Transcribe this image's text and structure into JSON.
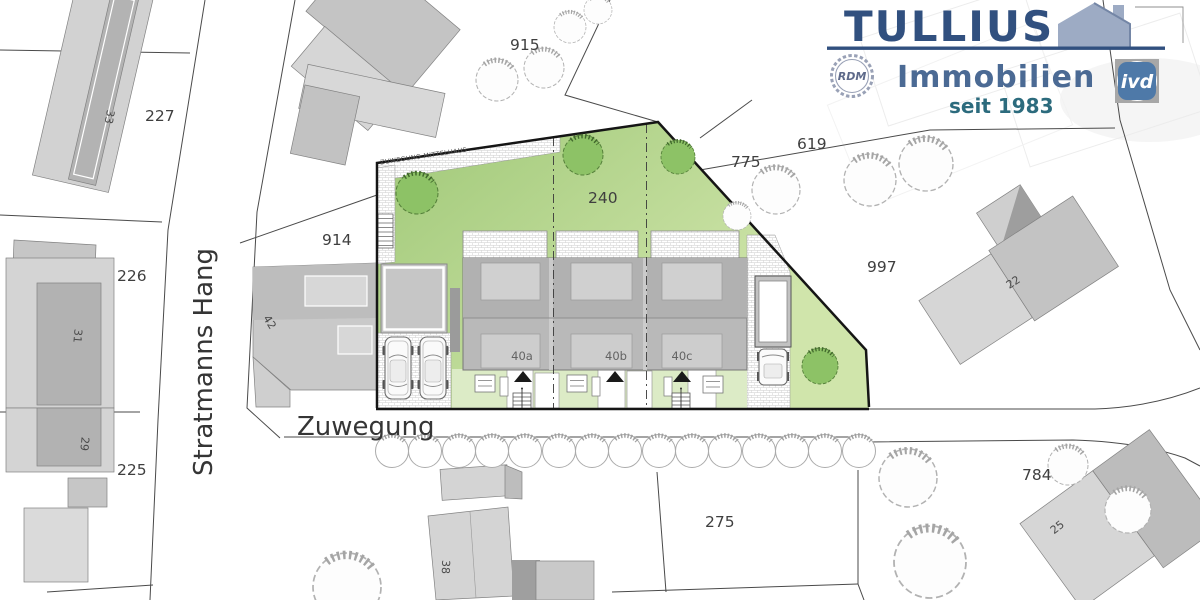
{
  "logo": {
    "brand": "TULLIUS",
    "line2": "Immobilien",
    "since": "seit 1983",
    "rdm": "RDM",
    "ivd": "ivd",
    "brand_color": "#31507f",
    "immobilien_color": "#4b6a94",
    "since_color": "#2c6b7d"
  },
  "streets": {
    "stratmanns_hang": "Stratmanns Hang",
    "zuwegung": "Zuwegung"
  },
  "plan": {
    "access_path": "ZUWEGUNG MITTELHAUS",
    "main_parcel_number": "240",
    "houses": {
      "h40a": "40a",
      "h40b": "40b",
      "h40c": "40c"
    },
    "parcels": {
      "p227": "227",
      "p226": "226",
      "p225": "225",
      "p275": "275",
      "p775": "775",
      "p619": "619",
      "p784": "784",
      "p914": "914",
      "p915": "915",
      "p997": "997"
    },
    "buildings": {
      "b22": "22",
      "b25": "25",
      "b29": "29",
      "b31": "31",
      "b33": "33",
      "b38": "38",
      "b42": "42"
    },
    "colors": {
      "lawn_top": "#9fc877",
      "lawn_bottom": "#d0e5ab",
      "front_garden": "#dcebc6",
      "tree_green": "#8dc266",
      "building_gray": "#b9b9b9"
    }
  }
}
